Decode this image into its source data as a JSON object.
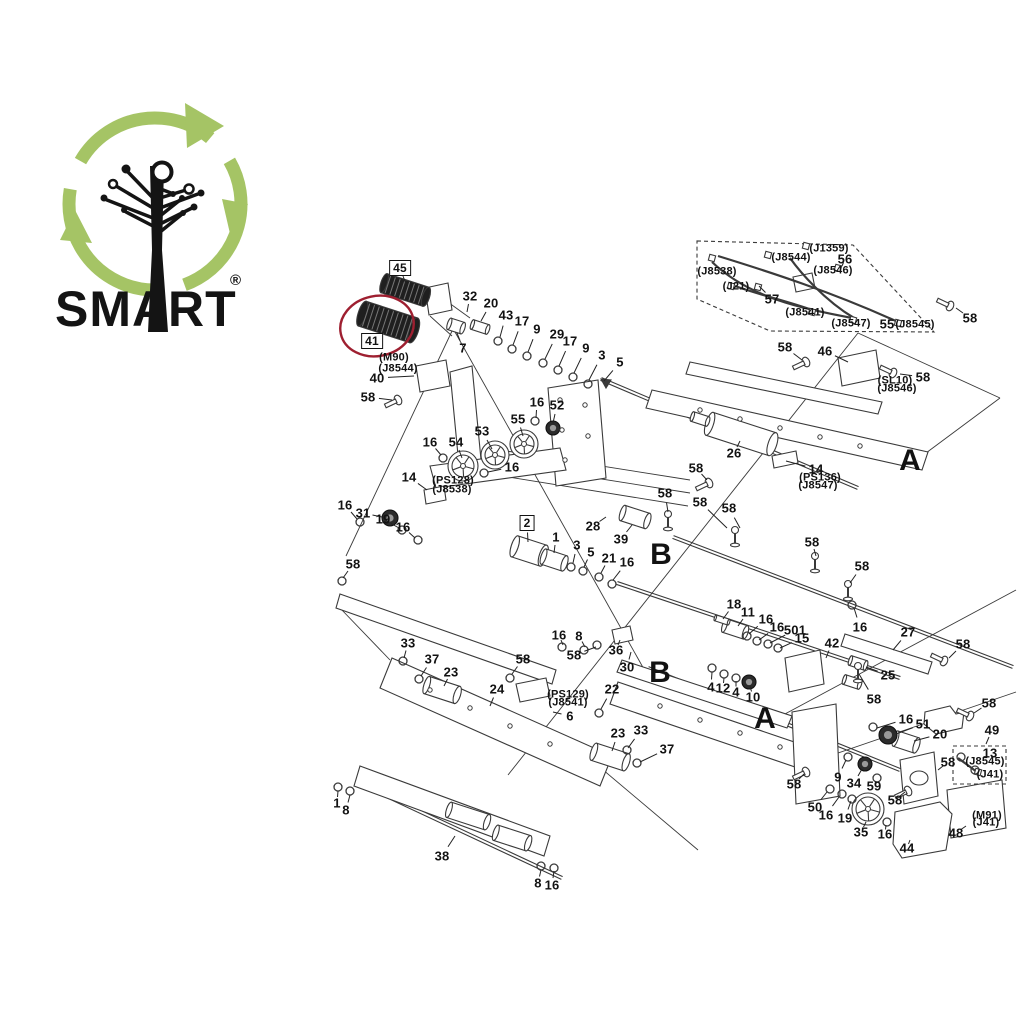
{
  "logo": {
    "brand": "SMART",
    "registered": "®",
    "ring_color": "#a5c465",
    "ink_color": "#141414"
  },
  "diagram": {
    "highlight": {
      "shape": "ellipse",
      "cx": 377,
      "cy": 326,
      "rx": 37,
      "ry": 30,
      "color": "#9e1f30",
      "around_part": "41"
    },
    "section_letters": [
      {
        "t": "A",
        "x": 910,
        "y": 461
      },
      {
        "t": "B",
        "x": 661,
        "y": 555
      },
      {
        "t": "B",
        "x": 660,
        "y": 673
      },
      {
        "t": "A",
        "x": 765,
        "y": 719
      }
    ],
    "part_labels": [
      {
        "t": "45",
        "x": 400,
        "y": 268,
        "box": true,
        "l": [
          406,
          284
        ]
      },
      {
        "t": "41",
        "x": 372,
        "y": 341,
        "box": true,
        "l": [
          381,
          331
        ]
      },
      {
        "t": "2",
        "x": 527,
        "y": 523,
        "box": true,
        "l": [
          528,
          542
        ]
      },
      {
        "t": "32",
        "x": 470,
        "y": 296,
        "l": [
          467,
          312
        ]
      },
      {
        "t": "20",
        "x": 491,
        "y": 303,
        "l": [
          481,
          321
        ]
      },
      {
        "t": "7",
        "x": 463,
        "y": 348,
        "l": [
          457,
          333
        ]
      },
      {
        "t": "43",
        "x": 506,
        "y": 315,
        "l": [
          500,
          337
        ]
      },
      {
        "t": "17",
        "x": 522,
        "y": 321,
        "l": [
          513,
          345
        ]
      },
      {
        "t": "9",
        "x": 537,
        "y": 329,
        "l": [
          528,
          352
        ]
      },
      {
        "t": "29",
        "x": 557,
        "y": 334,
        "l": [
          545,
          359
        ]
      },
      {
        "t": "17",
        "x": 570,
        "y": 341,
        "l": [
          559,
          366
        ]
      },
      {
        "t": "9",
        "x": 586,
        "y": 348,
        "l": [
          574,
          373
        ]
      },
      {
        "t": "3",
        "x": 602,
        "y": 355,
        "l": [
          589,
          380
        ]
      },
      {
        "t": "5",
        "x": 620,
        "y": 362,
        "l": [
          604,
          381
        ]
      },
      {
        "t": "(M90)",
        "x": 394,
        "y": 358
      },
      {
        "t": "(J8544)",
        "x": 398,
        "y": 369
      },
      {
        "t": "40",
        "x": 377,
        "y": 378,
        "l": [
          414,
          376
        ]
      },
      {
        "t": "58",
        "x": 368,
        "y": 397,
        "l": [
          392,
          400
        ]
      },
      {
        "t": "16",
        "x": 537,
        "y": 402,
        "l": [
          536,
          418
        ]
      },
      {
        "t": "52",
        "x": 557,
        "y": 405,
        "l": [
          553,
          423
        ]
      },
      {
        "t": "55",
        "x": 518,
        "y": 419,
        "l": [
          523,
          436
        ]
      },
      {
        "t": "53",
        "x": 482,
        "y": 431,
        "l": [
          492,
          449
        ]
      },
      {
        "t": "54",
        "x": 456,
        "y": 442,
        "l": [
          462,
          458
        ]
      },
      {
        "t": "16",
        "x": 430,
        "y": 442,
        "l": [
          441,
          455
        ]
      },
      {
        "t": "16",
        "x": 512,
        "y": 467,
        "l": [
          488,
          472
        ]
      },
      {
        "t": "14",
        "x": 409,
        "y": 477,
        "l": [
          427,
          490
        ]
      },
      {
        "t": "(PS128)",
        "x": 453,
        "y": 481
      },
      {
        "t": "(J8538)",
        "x": 452,
        "y": 490
      },
      {
        "t": "16",
        "x": 345,
        "y": 505,
        "l": [
          357,
          519
        ]
      },
      {
        "t": "31",
        "x": 363,
        "y": 513,
        "l": [
          382,
          517
        ]
      },
      {
        "t": "19",
        "x": 383,
        "y": 519,
        "l": [
          399,
          528
        ]
      },
      {
        "t": "16",
        "x": 403,
        "y": 527,
        "l": [
          415,
          538
        ]
      },
      {
        "t": "58",
        "x": 353,
        "y": 564,
        "l": [
          343,
          578
        ]
      },
      {
        "t": "1",
        "x": 556,
        "y": 537,
        "l": [
          554,
          553
        ]
      },
      {
        "t": "3",
        "x": 577,
        "y": 545,
        "l": [
          573,
          563
        ]
      },
      {
        "t": "5",
        "x": 591,
        "y": 552,
        "l": [
          584,
          567
        ]
      },
      {
        "t": "21",
        "x": 609,
        "y": 558,
        "l": [
          601,
          573
        ]
      },
      {
        "t": "16",
        "x": 627,
        "y": 562,
        "l": [
          613,
          580
        ]
      },
      {
        "t": "28",
        "x": 593,
        "y": 526,
        "l": [
          606,
          517
        ]
      },
      {
        "t": "39",
        "x": 621,
        "y": 539,
        "l": [
          632,
          525
        ]
      },
      {
        "t": "58",
        "x": 665,
        "y": 493,
        "l": [
          668,
          512
        ]
      },
      {
        "t": "58",
        "x": 700,
        "y": 502,
        "l": [
          727,
          528
        ]
      },
      {
        "t": "58",
        "x": 729,
        "y": 508,
        "l": [
          740,
          528
        ]
      },
      {
        "t": "(J8538)",
        "x": 717,
        "y": 272
      },
      {
        "t": "(J1359)",
        "x": 829,
        "y": 249
      },
      {
        "t": "(J8544)",
        "x": 791,
        "y": 258
      },
      {
        "t": "56",
        "x": 845,
        "y": 259,
        "l": [
          842,
          266
        ]
      },
      {
        "t": "(J8546)",
        "x": 833,
        "y": 271
      },
      {
        "t": "(J21)",
        "x": 736,
        "y": 287
      },
      {
        "t": "57",
        "x": 772,
        "y": 299,
        "l": [
          759,
          286
        ]
      },
      {
        "t": "(J8541)",
        "x": 805,
        "y": 313
      },
      {
        "t": "(J8547)",
        "x": 851,
        "y": 324
      },
      {
        "t": "55",
        "x": 887,
        "y": 324
      },
      {
        "t": "(J8545)",
        "x": 915,
        "y": 325
      },
      {
        "t": "58",
        "x": 970,
        "y": 318,
        "l": [
          956,
          308
        ]
      },
      {
        "t": "58",
        "x": 785,
        "y": 347,
        "l": [
          802,
          360
        ]
      },
      {
        "t": "46",
        "x": 825,
        "y": 351,
        "l": [
          848,
          362
        ]
      },
      {
        "t": "58",
        "x": 923,
        "y": 377,
        "l": [
          900,
          374
        ]
      },
      {
        "t": "(SL10)",
        "x": 895,
        "y": 381
      },
      {
        "t": "(J8546)",
        "x": 897,
        "y": 389
      },
      {
        "t": "26",
        "x": 734,
        "y": 453,
        "l": [
          740,
          441
        ]
      },
      {
        "t": "58",
        "x": 696,
        "y": 468,
        "l": [
          707,
          480
        ]
      },
      {
        "t": "14",
        "x": 816,
        "y": 469,
        "l": [
          786,
          461
        ]
      },
      {
        "t": "(PS136)",
        "x": 820,
        "y": 478
      },
      {
        "t": "(J8547)",
        "x": 818,
        "y": 486
      },
      {
        "t": "58",
        "x": 812,
        "y": 542,
        "l": [
          816,
          556
        ]
      },
      {
        "t": "58",
        "x": 862,
        "y": 566,
        "l": [
          850,
          583
        ]
      },
      {
        "t": "16",
        "x": 860,
        "y": 627,
        "l": [
          854,
          608
        ]
      },
      {
        "t": "27",
        "x": 908,
        "y": 632,
        "l": [
          893,
          650
        ]
      },
      {
        "t": "42",
        "x": 832,
        "y": 643,
        "l": [
          826,
          658
        ]
      },
      {
        "t": "25",
        "x": 888,
        "y": 675,
        "l": [
          866,
          667
        ]
      },
      {
        "t": "58",
        "x": 963,
        "y": 644,
        "l": [
          949,
          658
        ]
      },
      {
        "t": "501",
        "x": 795,
        "y": 630,
        "l": [
          770,
          643
        ]
      },
      {
        "t": "15",
        "x": 802,
        "y": 638,
        "l": [
          780,
          648
        ]
      },
      {
        "t": "18",
        "x": 734,
        "y": 604,
        "l": [
          723,
          619
        ]
      },
      {
        "t": "11",
        "x": 748,
        "y": 612,
        "l": [
          738,
          626
        ]
      },
      {
        "t": "16",
        "x": 766,
        "y": 619,
        "l": [
          749,
          634
        ]
      },
      {
        "t": "16",
        "x": 777,
        "y": 627,
        "l": [
          759,
          640
        ]
      },
      {
        "t": "16",
        "x": 559,
        "y": 635,
        "l": [
          563,
          645
        ]
      },
      {
        "t": "8",
        "x": 579,
        "y": 636,
        "l": [
          585,
          647
        ]
      },
      {
        "t": "58",
        "x": 574,
        "y": 655,
        "l": [
          596,
          647
        ]
      },
      {
        "t": "36",
        "x": 616,
        "y": 650,
        "l": [
          620,
          640
        ]
      },
      {
        "t": "30",
        "x": 627,
        "y": 667,
        "l": [
          631,
          652
        ]
      },
      {
        "t": "33",
        "x": 408,
        "y": 643,
        "l": [
          404,
          658
        ]
      },
      {
        "t": "37",
        "x": 432,
        "y": 659,
        "l": [
          421,
          676
        ]
      },
      {
        "t": "23",
        "x": 451,
        "y": 672,
        "l": [
          444,
          686
        ]
      },
      {
        "t": "24",
        "x": 497,
        "y": 689,
        "l": [
          490,
          706
        ]
      },
      {
        "t": "58",
        "x": 523,
        "y": 659,
        "l": [
          512,
          674
        ]
      },
      {
        "t": "(PS129)",
        "x": 568,
        "y": 695
      },
      {
        "t": "(J8541)",
        "x": 568,
        "y": 703
      },
      {
        "t": "6",
        "x": 570,
        "y": 716,
        "l": [
          553,
          712
        ]
      },
      {
        "t": "22",
        "x": 612,
        "y": 689,
        "l": [
          601,
          709
        ]
      },
      {
        "t": "23",
        "x": 618,
        "y": 733,
        "l": [
          612,
          751
        ]
      },
      {
        "t": "33",
        "x": 641,
        "y": 730,
        "l": [
          628,
          748
        ]
      },
      {
        "t": "37",
        "x": 667,
        "y": 749,
        "l": [
          640,
          762
        ]
      },
      {
        "t": "4",
        "x": 711,
        "y": 687,
        "l": [
          712,
          672
        ]
      },
      {
        "t": "12",
        "x": 723,
        "y": 688,
        "l": [
          724,
          678
        ]
      },
      {
        "t": "4",
        "x": 736,
        "y": 692,
        "l": [
          736,
          681
        ]
      },
      {
        "t": "10",
        "x": 753,
        "y": 697,
        "l": [
          750,
          686
        ]
      },
      {
        "t": "58",
        "x": 874,
        "y": 699,
        "l": [
          859,
          674
        ]
      },
      {
        "t": "58",
        "x": 794,
        "y": 784,
        "l": [
          804,
          774
        ]
      },
      {
        "t": "9",
        "x": 838,
        "y": 777,
        "l": [
          846,
          760
        ]
      },
      {
        "t": "34",
        "x": 854,
        "y": 783,
        "l": [
          862,
          769
        ]
      },
      {
        "t": "59",
        "x": 874,
        "y": 786,
        "l": [
          876,
          781
        ]
      },
      {
        "t": "50",
        "x": 815,
        "y": 807,
        "l": [
          827,
          792
        ]
      },
      {
        "t": "16",
        "x": 826,
        "y": 815,
        "l": [
          839,
          797
        ]
      },
      {
        "t": "19",
        "x": 845,
        "y": 818,
        "l": [
          851,
          801
        ]
      },
      {
        "t": "35",
        "x": 861,
        "y": 832,
        "l": [
          866,
          822
        ]
      },
      {
        "t": "16",
        "x": 885,
        "y": 834,
        "l": [
          886,
          825
        ]
      },
      {
        "t": "44",
        "x": 907,
        "y": 848,
        "l": [
          910,
          840
        ]
      },
      {
        "t": "48",
        "x": 956,
        "y": 833,
        "l": [
          966,
          826
        ]
      },
      {
        "t": "(M91)",
        "x": 987,
        "y": 816
      },
      {
        "t": "(J41)",
        "x": 986,
        "y": 823
      },
      {
        "t": "58",
        "x": 948,
        "y": 762,
        "l": [
          938,
          770
        ]
      },
      {
        "t": "13",
        "x": 990,
        "y": 753
      },
      {
        "t": "(J8545)",
        "x": 985,
        "y": 762
      },
      {
        "t": "(J41)",
        "x": 990,
        "y": 775
      },
      {
        "t": "49",
        "x": 992,
        "y": 730,
        "l": [
          986,
          744
        ]
      },
      {
        "t": "58",
        "x": 989,
        "y": 703,
        "l": [
          974,
          713
        ]
      },
      {
        "t": "16",
        "x": 906,
        "y": 719,
        "l": [
          877,
          728
        ]
      },
      {
        "t": "51",
        "x": 923,
        "y": 724,
        "l": [
          896,
          734
        ]
      },
      {
        "t": "20",
        "x": 940,
        "y": 734,
        "l": [
          914,
          741
        ]
      },
      {
        "t": "58",
        "x": 895,
        "y": 800,
        "l": [
          905,
          792
        ]
      },
      {
        "t": "1",
        "x": 337,
        "y": 803,
        "l": [
          338,
          791
        ]
      },
      {
        "t": "8",
        "x": 346,
        "y": 810,
        "l": [
          350,
          795
        ]
      },
      {
        "t": "38",
        "x": 442,
        "y": 856,
        "l": [
          455,
          836
        ]
      },
      {
        "t": "8",
        "x": 538,
        "y": 883,
        "l": [
          541,
          870
        ]
      },
      {
        "t": "16",
        "x": 552,
        "y": 885,
        "l": [
          554,
          871
        ]
      }
    ]
  }
}
